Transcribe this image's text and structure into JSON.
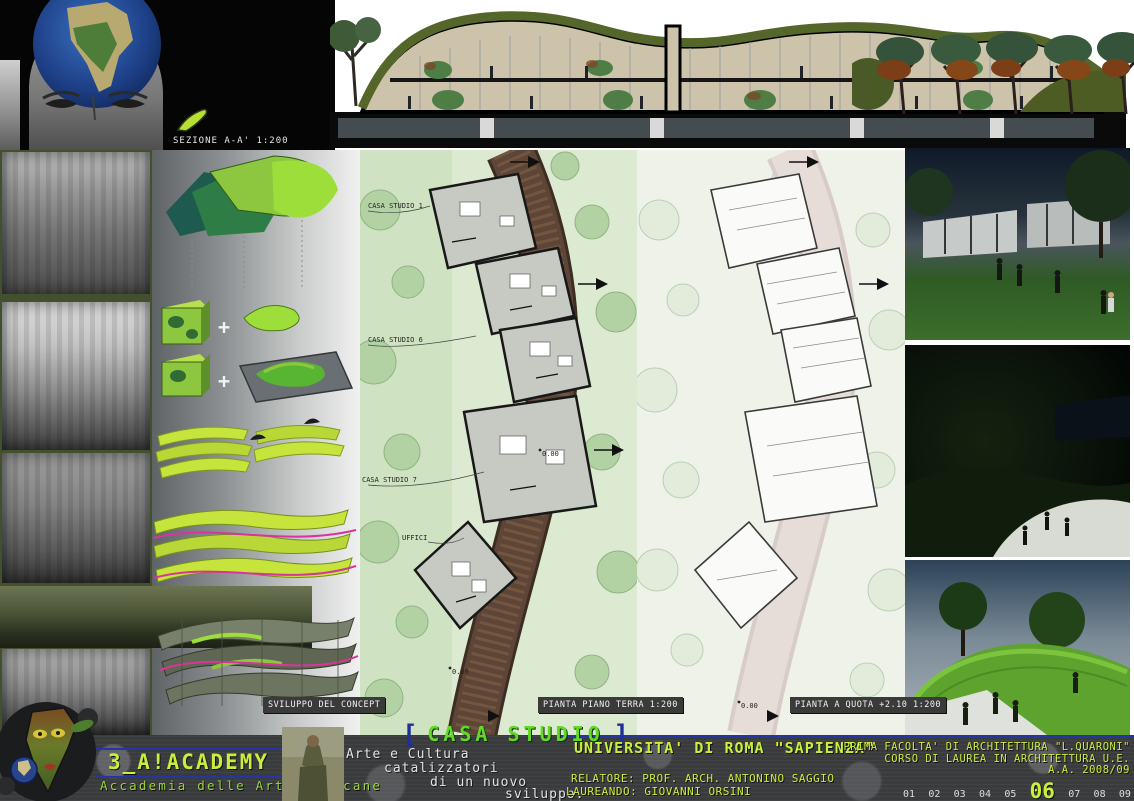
{
  "header": {
    "section_label": "SEZIONE A-A' 1:200"
  },
  "plans": {
    "concept_caption": "SVILUPPO DEL CONCEPT",
    "ground_caption": "PIANTA PIANO TERRA 1:200",
    "upper_caption": "PIANTA A QUOTA +2.10 1:200",
    "building_labels": {
      "casa1": "CASA STUDIO 1",
      "casa6": "CASA STUDIO 6",
      "casa7": "CASA STUDIO 7",
      "uffici": "UFFICI"
    },
    "elevation_mark": "0.00",
    "concept_plus": "+"
  },
  "footer": {
    "project_title": "CASA STUDIO",
    "bracket_left": "[",
    "bracket_right": "]",
    "academy": {
      "name": "3_A!ACADEMY",
      "subtitle": "Accademia delle Arti Africane"
    },
    "tagline": {
      "line1": "Arte e Cultura",
      "line2": "catalizzatori",
      "line3": "di un nuovo",
      "line4": "sviluppo."
    },
    "university": "UNIVERSITA' DI ROMA \"SAPIENZA\"",
    "faculty": "PRIMA FACOLTA' DI ARCHITETTURA \"L.QUARONI\"",
    "course": "CORSO DI LAUREA IN ARCHITETTURA U.E.",
    "academic_year": "A.A. 2008/09",
    "advisor": "RELATORE: PROF. ARCH. ANTONINO SAGGIO",
    "student": "LAUREANDO: GIOVANNI ORSINI",
    "pages": [
      "01",
      "02",
      "03",
      "04",
      "05",
      "06",
      "07",
      "08",
      "09"
    ],
    "current_page": "06"
  },
  "colors": {
    "lime_text": "#c9ee3b",
    "title_green": "#63d926",
    "blue_accent": "#2336a3",
    "plan_green": "#dcead2",
    "footer_bg": "#3a3b3d",
    "board_black": "#050505"
  }
}
